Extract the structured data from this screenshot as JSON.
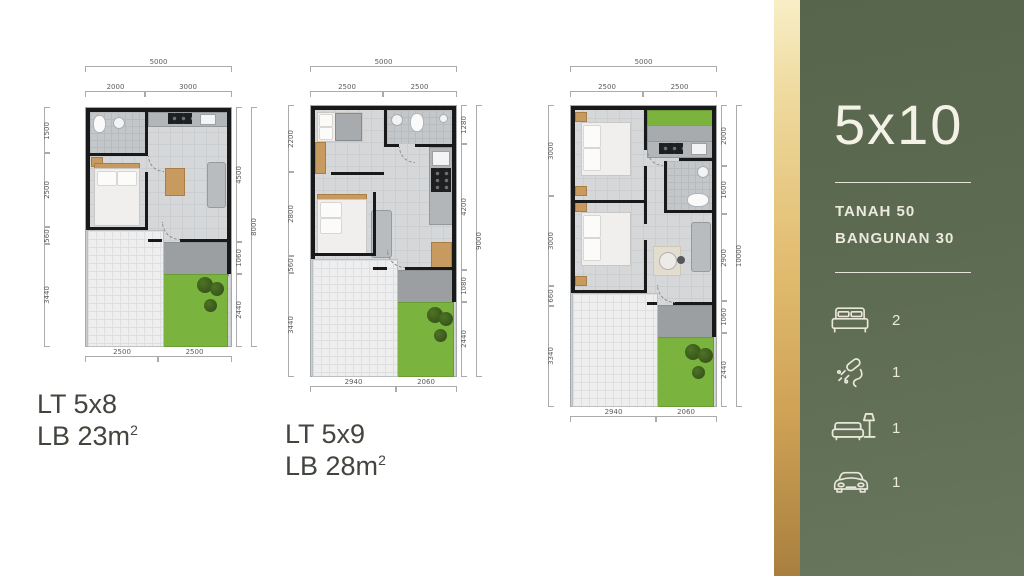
{
  "panel": {
    "title": "5x10",
    "land_label": "TANAH 50",
    "building_label": "BANGUNAN 30",
    "features": [
      {
        "icon": "bed-icon",
        "count": "2"
      },
      {
        "icon": "shower-icon",
        "count": "1"
      },
      {
        "icon": "sofa-icon",
        "count": "1"
      },
      {
        "icon": "car-icon",
        "count": "1"
      }
    ],
    "colors": {
      "panel_bg": "#5d6b53",
      "accent_gold": "#e2bd71",
      "text": "#f2efe4"
    }
  },
  "plans": [
    {
      "name": "LT 5x8",
      "area": "LB 23m",
      "area_sup": "2",
      "dims": {
        "top_total": "5000",
        "top": [
          "2000",
          "3000"
        ],
        "left": [
          "1500",
          "2500",
          "560",
          "3440"
        ],
        "right": [
          "4500",
          "1060",
          "2440"
        ],
        "right_total": "8000",
        "bottom": [
          "2500",
          "2500"
        ]
      }
    },
    {
      "name": "LT 5x9",
      "area": "LB 28m",
      "area_sup": "2",
      "dims": {
        "top_total": "5000",
        "top": [
          "2500",
          "2500"
        ],
        "left": [
          "2200",
          "2800",
          "560",
          "3440"
        ],
        "right": [
          "1280",
          "4200",
          "1080",
          "2440"
        ],
        "right_total": "9000",
        "bottom": [
          "2940",
          "2060"
        ]
      }
    },
    {
      "dims": {
        "top_total": "5000",
        "top": [
          "2500",
          "2500"
        ],
        "left": [
          "3000",
          "3000",
          "660",
          "3340"
        ],
        "right": [
          "2000",
          "1600",
          "2900",
          "1060",
          "2440"
        ],
        "right_total": "10000",
        "bottom": [
          "2940",
          "2060"
        ]
      }
    }
  ]
}
